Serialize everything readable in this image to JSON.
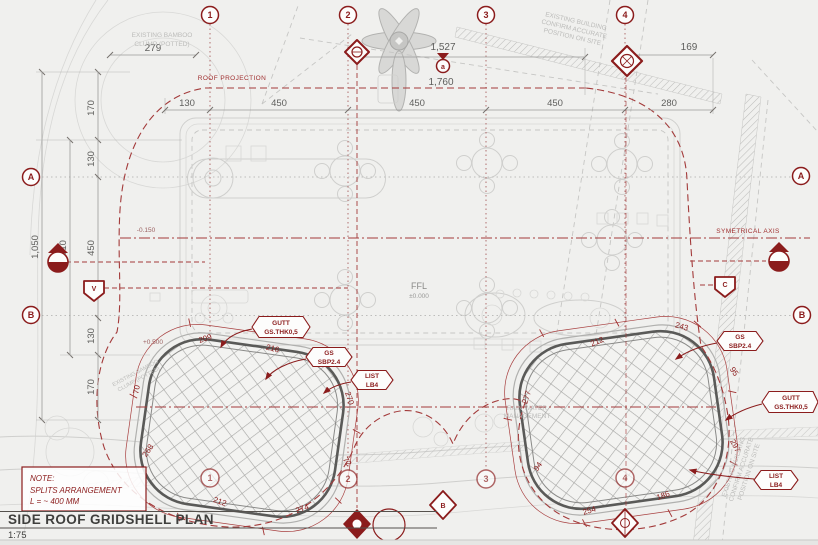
{
  "title_block": {
    "title": "SIDE ROOF GRIDSHELL PLAN",
    "scale": "1:75"
  },
  "note": {
    "heading": "NOTE:",
    "line1": "SPLITS ARRANGEMENT",
    "line2": "L = ~ 400 MM"
  },
  "grid_markers": {
    "c1": "1",
    "c2": "2",
    "c3": "3",
    "c4": "4",
    "rA": "A",
    "rB": "B"
  },
  "ref_markers": {
    "top_circle": "a",
    "bottom_diamond": "B",
    "left_pentagon": "V",
    "right_pentagon": "C"
  },
  "levels": {
    "ffl": "FFL",
    "ffl_value": "±0.000",
    "minus": "-0.150",
    "plus": "+0.500"
  },
  "labels": {
    "bamboo1": "EXISTING BAMBOO",
    "bamboo2": "CLUMP (POTTED)",
    "building1": "EXISTING BUILDING",
    "building2": "CONFIRM ACCURATE",
    "building3": "POSITION ON SITE",
    "roof_projection": "ROOF PROJECTION",
    "symetrical_axis": "SYMETRICAL AXIS",
    "rain1": "RAIN WATER",
    "rain2": "MANAGEMENT"
  },
  "dims": {
    "top279": "279",
    "top1527": "1,527",
    "top169": "169",
    "proj1760": "1,760",
    "row": [
      "130",
      "450",
      "450",
      "450",
      "280"
    ],
    "left_chain": [
      "170",
      "130",
      "450",
      "130",
      "170"
    ],
    "left_total": "1,050",
    "left_mid": "710",
    "shell_left": [
      "209",
      "216",
      "270",
      "72",
      "274",
      "212",
      "268",
      "70"
    ],
    "shell_right": [
      "243",
      "212",
      "277",
      "94",
      "254",
      "186",
      "297",
      "95"
    ]
  },
  "tags": {
    "gutt1": "GUTT",
    "gutt2": "GS.THK0,5",
    "gs1": "GS",
    "gs2": "SBP2.4",
    "list1": "LIST",
    "list2": "LB4"
  },
  "colors": {
    "accent_red": "#8b1c1c",
    "dash_red": "#a33a3a",
    "line_gray": "#cfcfcd",
    "text_gray": "#5f5f5d"
  }
}
